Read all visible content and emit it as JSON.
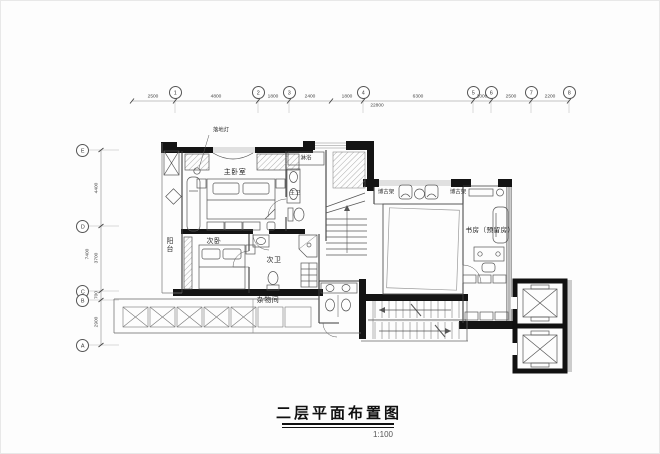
{
  "title_block": {
    "title": "二层平面布置图",
    "scale": "1:100"
  },
  "grid": {
    "top": [
      "1",
      "2",
      "3",
      "4",
      "5",
      "6",
      "7",
      "8"
    ],
    "left": [
      "E",
      "D",
      "C",
      "B",
      "A"
    ]
  },
  "dims": {
    "top": [
      "2500",
      "4800",
      "1800",
      "2400",
      "1800",
      "6300",
      "1000",
      "2500",
      "2200"
    ],
    "top_overall": "22800",
    "left": [
      "4400",
      "3700",
      "700",
      "2900"
    ],
    "left_overall": "7400"
  },
  "labels": {
    "floor_lamp": "落地灯",
    "master_bedroom": "主卧室",
    "master_bath": "主卫",
    "shower": "淋浴",
    "shelf_left": "博古架",
    "shelf_right": "博古架",
    "study": "书房（预留房）",
    "second_bedroom": "次卧",
    "second_bath": "次卫",
    "storage": "杂物间",
    "balcony": "阳台"
  }
}
